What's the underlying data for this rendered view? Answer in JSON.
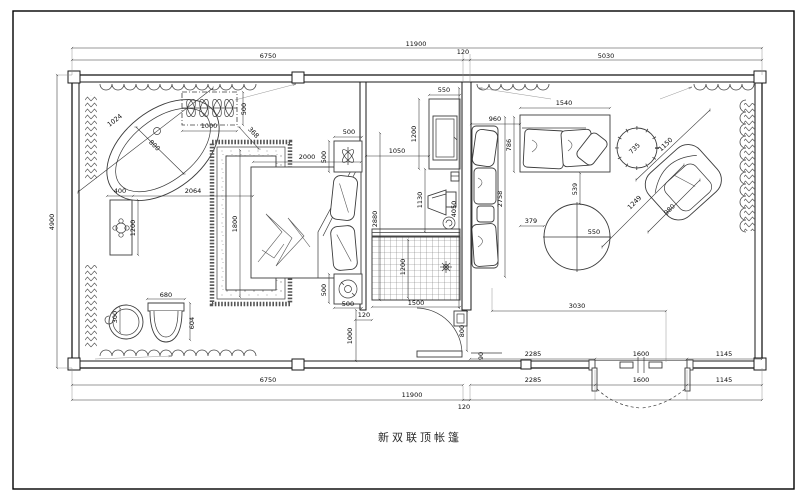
{
  "title": {
    "text": "新双联顶帐篷"
  },
  "dims": {
    "top": {
      "total": "11900",
      "seg1": "6750",
      "gap": "120",
      "seg2": "5030"
    },
    "left": {
      "total": "4900"
    },
    "bottom": {
      "rowA": {
        "s1": "2285",
        "s2": "1600",
        "s3": "1145"
      },
      "rowB": {
        "s0": "6750",
        "s1": "2285",
        "s2": "1600",
        "s3": "1145"
      },
      "rowC": {
        "total": "11900",
        "gap": "120"
      }
    },
    "bath": {
      "tub_axis": "1024",
      "tub_radius": "800",
      "planter_w": "1000",
      "planter_d": "500",
      "leader": "368",
      "off_vanity": "400",
      "off_rug": "2064",
      "vanity_len": "1200",
      "basin": "300",
      "toilet_w": "680",
      "toilet_d": "604"
    },
    "bed": {
      "rug_w": "1800",
      "bed_len": "2000",
      "ns_top_w": "500",
      "ns_top_d": "500",
      "ns_bot_d": "500",
      "ns_bot_w": "500",
      "aisle_len": "2880",
      "wall_gap": "120",
      "entry_w": "1000"
    },
    "tv": {
      "console_w": "550",
      "console_len": "1200",
      "offset": "1050",
      "stand_len": "1130",
      "mat_w": "1500",
      "mat_len": "1200",
      "wall_len": "4050",
      "door_swing": "800",
      "jamb": "90"
    },
    "living": {
      "sofa_off": "960",
      "sofa_w": "1540",
      "sofa_d": "786",
      "zone_d": "2758",
      "table_off_y": "539",
      "table_off_x": "379",
      "table_r": "550",
      "diag": "1249",
      "chair_w": "1150",
      "chair_d": "980",
      "side_table": "735",
      "zone_w": "3030"
    }
  }
}
